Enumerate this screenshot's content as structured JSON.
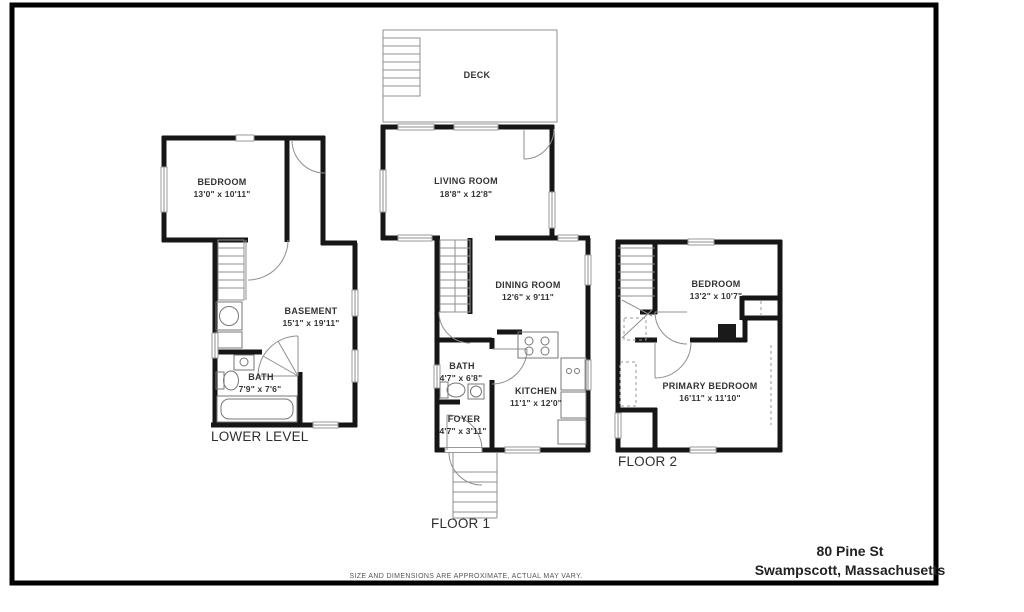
{
  "floors": {
    "lower": {
      "label": "LOWER LEVEL",
      "rooms": {
        "bedroom": {
          "name": "BEDROOM",
          "dims": "13'0\" x 10'11\""
        },
        "basement": {
          "name": "BASEMENT",
          "dims": "15'1\" x 19'11\""
        },
        "bath": {
          "name": "BATH",
          "dims": "7'9\" x 7'6\""
        }
      }
    },
    "floor1": {
      "label": "FLOOR 1",
      "rooms": {
        "deck": {
          "name": "DECK"
        },
        "living": {
          "name": "LIVING ROOM",
          "dims": "18'8\" x 12'8\""
        },
        "dining": {
          "name": "DINING ROOM",
          "dims": "12'6\" x 9'11\""
        },
        "kitchen": {
          "name": "KITCHEN",
          "dims": "11'1\" x 12'0\""
        },
        "bath": {
          "name": "BATH",
          "dims": "4'7\" x 6'8\""
        },
        "foyer": {
          "name": "FOYER",
          "dims": "4'7\" x 3'11\""
        }
      }
    },
    "floor2": {
      "label": "FLOOR 2",
      "rooms": {
        "bedroom": {
          "name": "BEDROOM",
          "dims": "13'2\" x 10'7\""
        },
        "primary": {
          "name": "PRIMARY BEDROOM",
          "dims": "16'11\" x 11'10\""
        }
      }
    }
  },
  "title_block": {
    "address_line1": "80 Pine St",
    "address_line2": "Swampscott, Massachusetts"
  },
  "disclaimer": "SIZE AND DIMENSIONS ARE APPROXIMATE, ACTUAL MAY VARY.",
  "colors": {
    "wall": "#161616",
    "thin_line": "#8f8f8f",
    "frame": "#000000",
    "text": "#333333"
  }
}
